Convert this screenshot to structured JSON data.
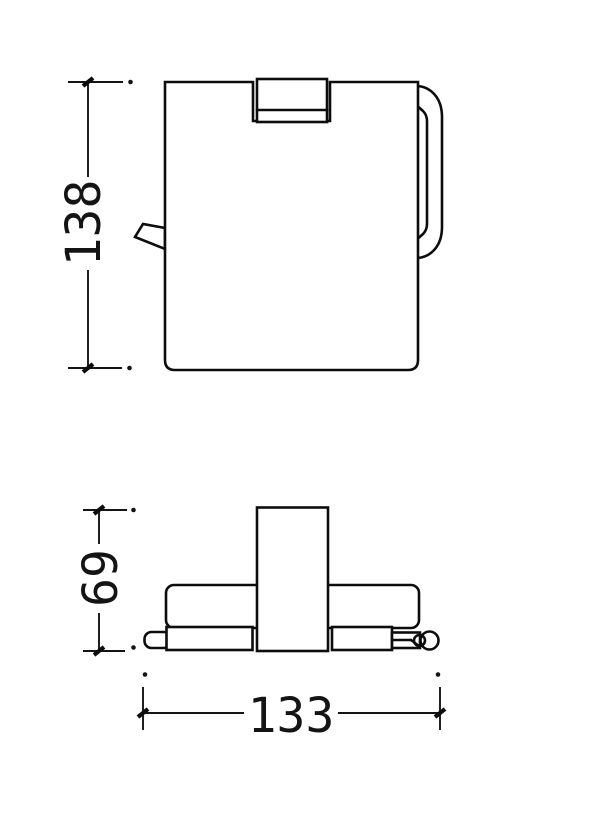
{
  "page": {
    "background": "#ffffff"
  },
  "drawing": {
    "kind": "orthographic-dimension-drawing",
    "line_color": "#0d0d0d",
    "dimensions": {
      "height": {
        "label": "138"
      },
      "depth": {
        "label": "69"
      },
      "width": {
        "label": "133"
      }
    }
  }
}
